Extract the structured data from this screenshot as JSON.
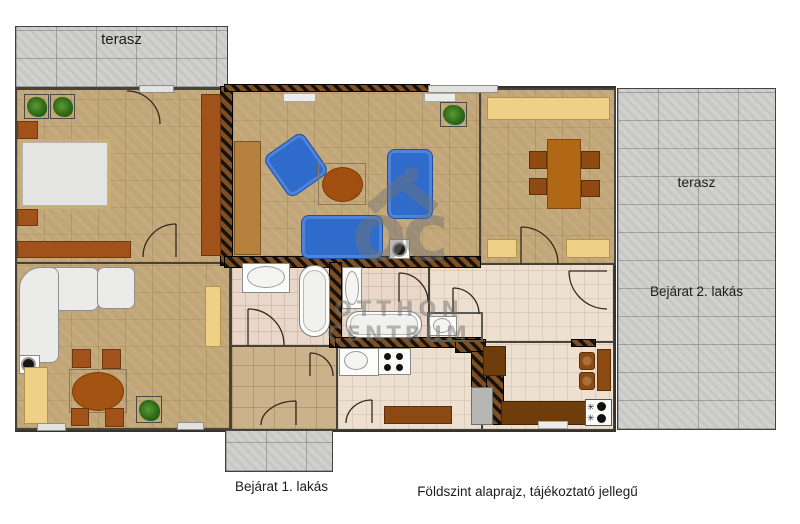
{
  "labels": {
    "terrace_top": "terasz",
    "terrace_right": "terasz",
    "entrance_2": "Bejárat 2. lakás",
    "entrance_1": "Bejárat 1. lakás",
    "caption": "Földszint alaprajz, tájékoztató jellegű"
  },
  "watermark": {
    "monogram": "oc",
    "brand_line1": "OTTHON",
    "brand_line2": "CENTRUM"
  },
  "colors": {
    "background": "#ffffff",
    "floor_wood": "#c7ac7e",
    "terrace_tile": "#d2d2d0",
    "bathroom_tile": "#e9d8c9",
    "kitchen_tile": "#eee0d1",
    "hall_tile": "#ccb28b",
    "furniture_brown": "#a0521a",
    "furniture_dark_brown": "#6f3d0c",
    "sofa_blue": "#2e6bcb",
    "cabinet_yellow": "#eed187",
    "wall_hatch_dark": "#16130f",
    "wall_hatch_brown": "#7d4f22",
    "watermark_gray": "#737373"
  }
}
